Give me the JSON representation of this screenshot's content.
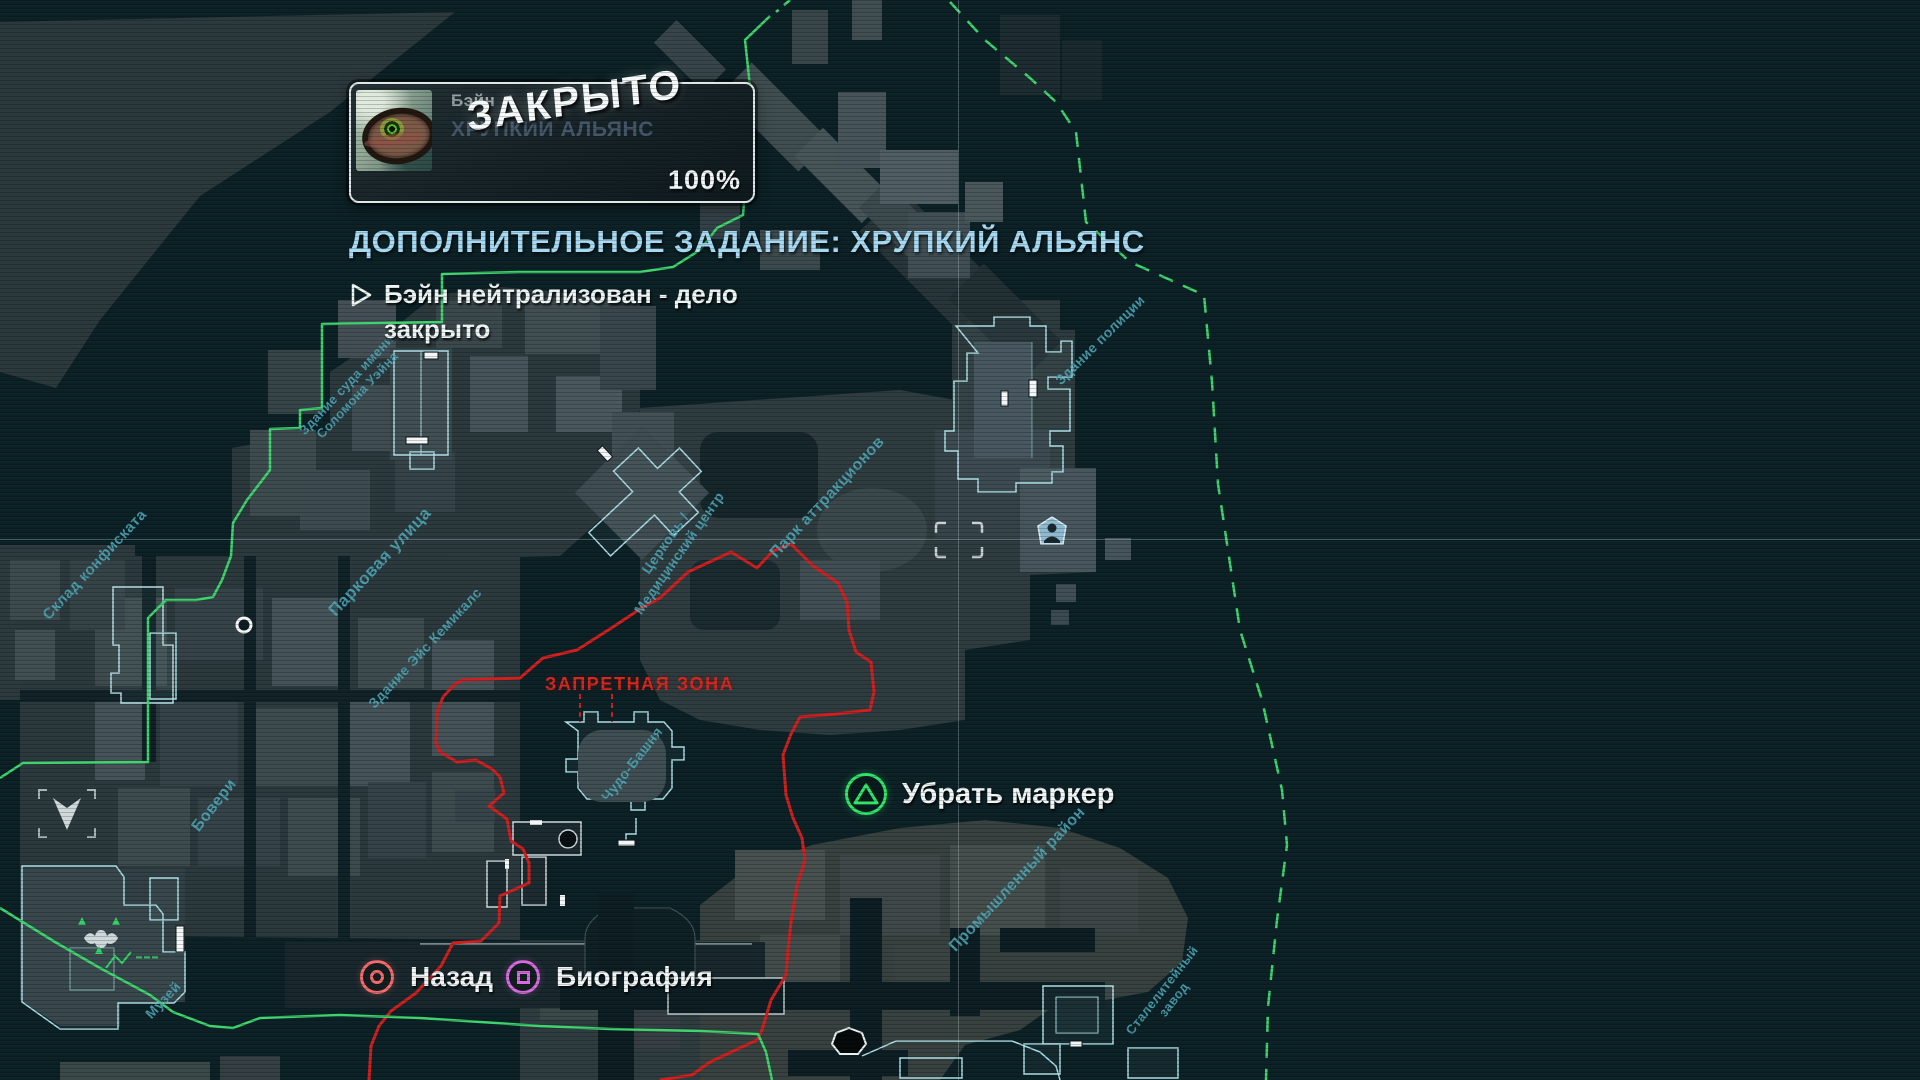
{
  "hud": {
    "mission_card": {
      "character_name": "Бэйн",
      "mission_name": "ХРУПКИЙ АЛЬЯНС",
      "stamp": "ЗАКРЫТО",
      "progress": "100%",
      "portrait_icon": "bane-eye-portrait"
    },
    "mission_title": "ДОПОЛНИТЕЛЬНОЕ ЗАДАНИЕ: ХРУПКИЙ АЛЬЯНС",
    "objective": {
      "line1": "Бэйн нейтрализован - дело",
      "line2": "закрыто"
    },
    "actions": {
      "remove_marker": {
        "label": "Убрать маркер",
        "button_icon": "ps-triangle-button"
      },
      "back": {
        "label": "Назад",
        "button_icon": "ps-circle-button"
      },
      "biography": {
        "label": "Биография",
        "button_icon": "ps-square-button"
      }
    }
  },
  "map": {
    "restricted_zone_label": "ЗАПРЕТНАЯ ЗОНА",
    "labels": [
      {
        "text": "Склад конфиската"
      },
      {
        "text": "Парковая улица"
      },
      {
        "text": "Здание Эйс Кемикалс"
      },
      {
        "text": "Здание суда имени\nСоломона Уэйна"
      },
      {
        "text": "Церковь /\nМедицинский центр"
      },
      {
        "text": "Парк аттракционов"
      },
      {
        "text": "Здание полиции"
      },
      {
        "text": "Чудо-Башня"
      },
      {
        "text": "Бовери"
      },
      {
        "text": "Музей"
      },
      {
        "text": "Промышленный район"
      },
      {
        "text": "Сталелитейный\nзавод"
      }
    ]
  },
  "colors": {
    "accent_blue": "#a6d9f2",
    "label_teal": "#4fa8b8",
    "boundary_green": "#3fd36d",
    "restricted_red": "#d5281e",
    "building_outline_cyan": "#aadbe4",
    "btn_triangle_green": "#2ee567",
    "btn_circle_red": "#f56a6a",
    "btn_square_pink": "#d86ae0"
  }
}
